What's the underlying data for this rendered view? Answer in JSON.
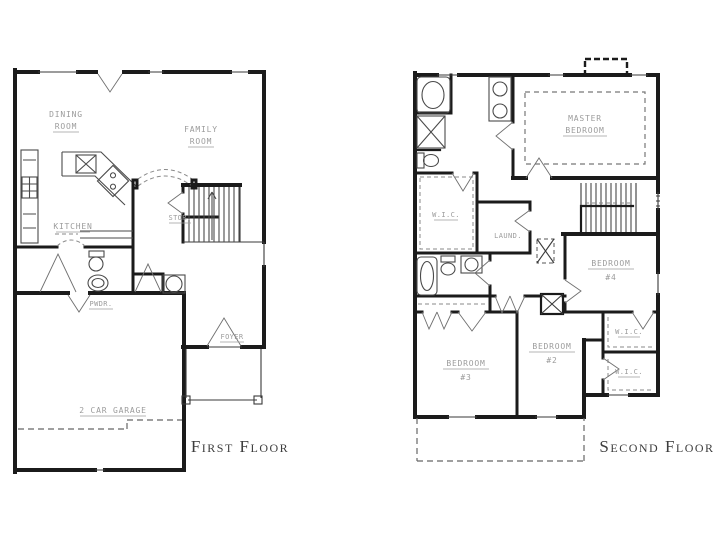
{
  "palette": {
    "background": "#ffffff",
    "wall": "#1b1b1b",
    "fixture": "#4a4a4a",
    "dashed": "#8a8a8a",
    "label": "#9c9c9c",
    "caption": "#3d3d3d"
  },
  "first_floor": {
    "caption": "First Floor",
    "labels": {
      "dining_line1": "DINING",
      "dining_line2": "ROOM",
      "family_line1": "FAMILY",
      "family_line2": "ROOM",
      "kitchen": "KITCHEN",
      "storage": "STOR.",
      "powder": "PWDR.",
      "foyer": "FOYER",
      "garage": "2 CAR GARAGE"
    }
  },
  "second_floor": {
    "caption": "Second Floor",
    "labels": {
      "master_line1": "MASTER",
      "master_line2": "BEDROOM",
      "master_closet": "W.I.C.",
      "laundry": "LAUND.",
      "bedroom4_line1": "BEDROOM",
      "bedroom4_line2": "#4",
      "bedroom3_line1": "BEDROOM",
      "bedroom3_line2": "#3",
      "bedroom2_line1": "BEDROOM",
      "bedroom2_line2": "#2",
      "closet_upper": "W.I.C.",
      "closet_lower": "W.I.C."
    }
  }
}
